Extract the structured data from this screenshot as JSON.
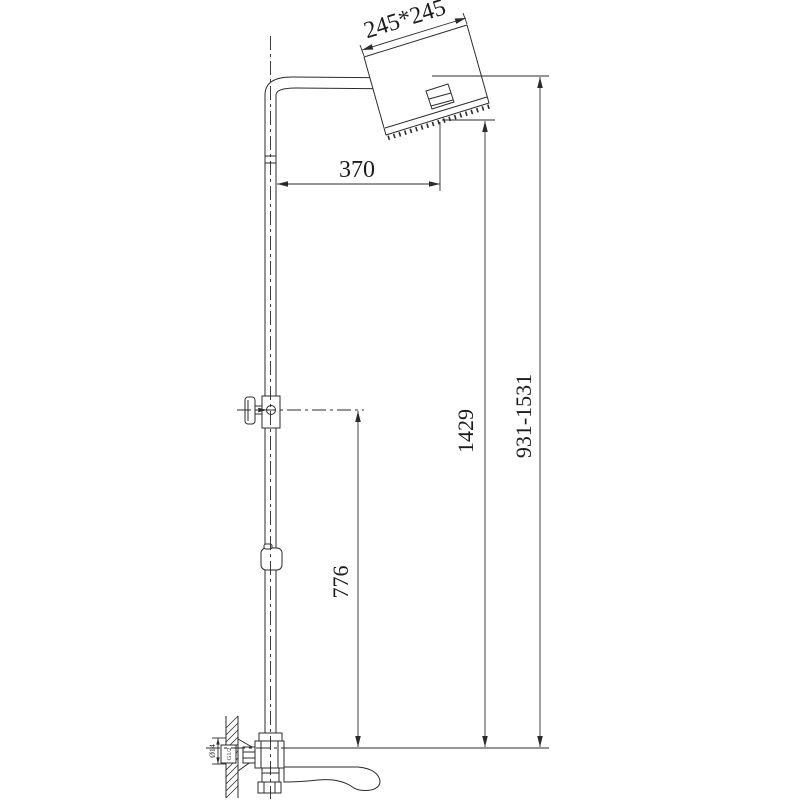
{
  "drawing": {
    "background": "#ffffff",
    "line_color": "#2b2b2b",
    "labels": {
      "head_size": "245*245",
      "arm_reach": "370",
      "slider_height": "776",
      "column_height": "1429",
      "overall_height_range": "931-1531",
      "escutcheon_diameter": "Ø14",
      "wall_thread": "G1/2"
    }
  }
}
